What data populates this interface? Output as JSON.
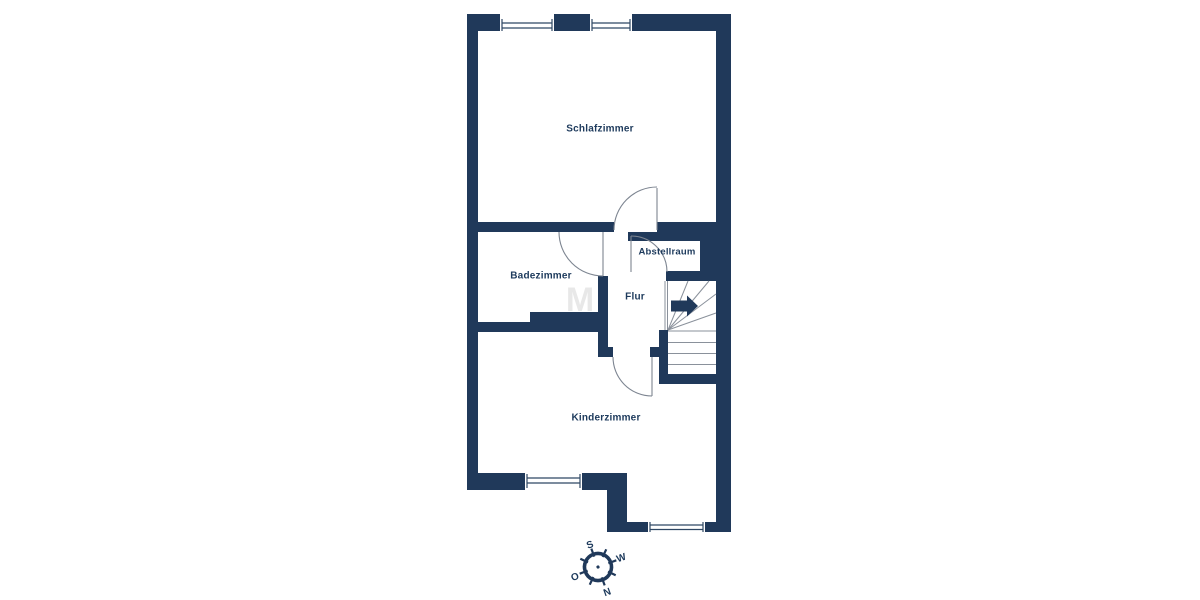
{
  "colors": {
    "wall": "#20395a",
    "door_line": "#7d8591",
    "window_line": "#2e4763",
    "text": "#1d3a5c",
    "background": "#ffffff"
  },
  "rooms": {
    "schlafzimmer": {
      "label": "Schlafzimmer"
    },
    "badezimmer": {
      "label": "Badezimmer"
    },
    "abstellraum": {
      "label": "Abstellraum"
    },
    "flur": {
      "label": "Flur"
    },
    "kinderzimmer": {
      "label": "Kinderzimmer"
    }
  },
  "compass": {
    "north": "N",
    "south": "S",
    "east": "O",
    "west": "W"
  },
  "watermark": "M"
}
